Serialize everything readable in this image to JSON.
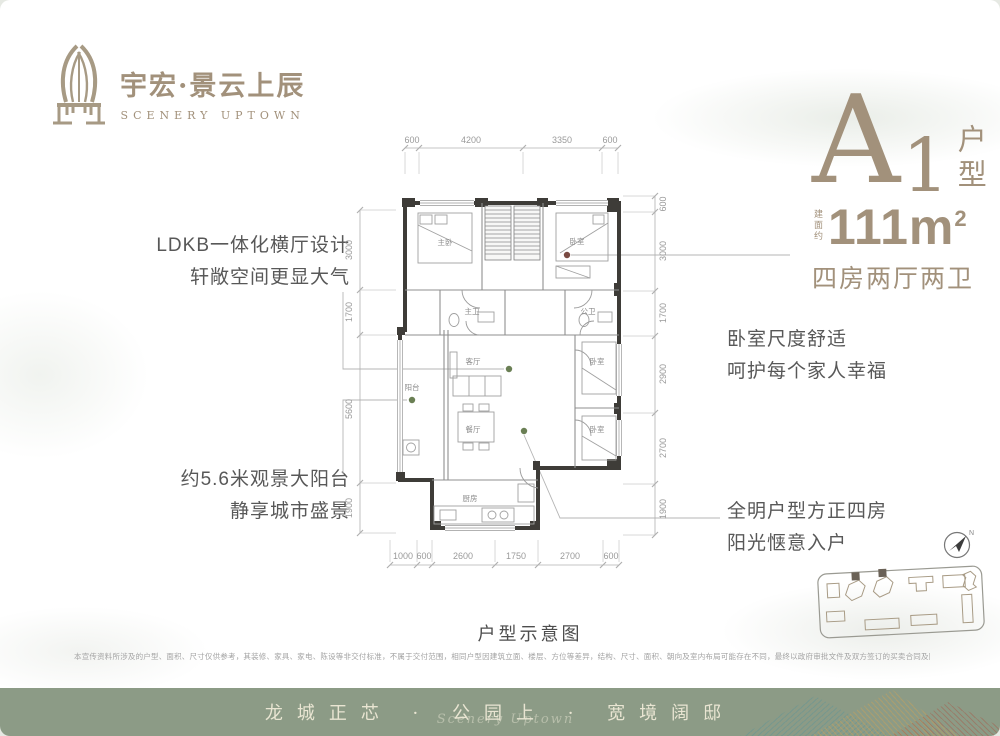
{
  "brand": {
    "name": "宇宏·景云上辰",
    "subtitle": "SCENERY UPTOWN"
  },
  "unit": {
    "letter": "A",
    "number": "1",
    "suffix": "户型",
    "area_prefix": "建面约",
    "area_value": "111m",
    "area_sup": "2",
    "layout": "四房两厅两卫"
  },
  "annotations": {
    "left_top": [
      "LDKB一体化横厅设计",
      "轩敞空间更显大气"
    ],
    "left_bottom": [
      "约5.6米观景大阳台",
      "静享城市盛景"
    ],
    "right_top": [
      "卧室尺度舒适",
      "呵护每个家人幸福"
    ],
    "right_bottom": [
      "全明户型方正四房",
      "阳光惬意入户"
    ]
  },
  "floorplan": {
    "caption": "户型示意图",
    "dims_top": [
      "600",
      "4200",
      "3350",
      "600"
    ],
    "dims_bottom": [
      "1000",
      "600",
      "2600",
      "1750",
      "2700",
      "600"
    ],
    "dims_left": [
      "3000",
      "1700",
      "5600",
      "1900"
    ],
    "dims_right": [
      "600",
      "3000",
      "1700",
      "2900",
      "2700",
      "1900"
    ],
    "rooms": {
      "master": "主卧",
      "bedroom": "卧室",
      "master_bath": "主卫",
      "bath": "公卫",
      "living": "客厅",
      "dining": "餐厅",
      "kitchen": "厨房",
      "balcony": "阳台"
    }
  },
  "compass": {
    "label": "N"
  },
  "disclaimer": "本宣传资料所涉及的户型、面积、尺寸仅供参考，其装修、家具、家电、陈设等非交付标准，不属于交付范围，相同户型因建筑立面、楼层、方位等差异，结构、尺寸、面积、朝向及室内布局可能存在不同，最终以政府审批文件及双方签订的买卖合同及附件为准。本公司保留对宣传资料修改的权利，敬请留意最新资料。",
  "footer": {
    "slogan": "龙城正芯 · 公园上 · 宽境阔邸",
    "signature": "Scenery Uptown"
  },
  "colors": {
    "brand": "#a2917b",
    "footer_bg": "#8c9b86",
    "wall": "#3e3c38",
    "dim": "#9a9a9a",
    "dot_green": "#6a7f54",
    "dot_red": "#7a4a42"
  }
}
